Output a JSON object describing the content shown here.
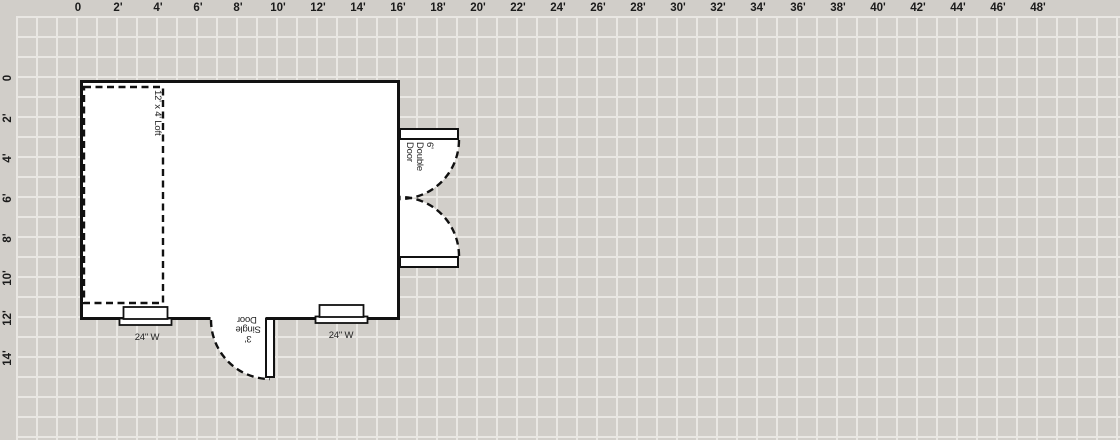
{
  "canvas": {
    "background_color": "#d1cec9",
    "gridline_color": "#e9e7e3",
    "wall_color": "#111111",
    "fill_color": "#ffffff"
  },
  "ruler": {
    "top_labels": [
      "0",
      "2'",
      "4'",
      "6'",
      "8'",
      "10'",
      "12'",
      "14'",
      "16'",
      "18'",
      "20'",
      "22'",
      "24'",
      "26'",
      "28'",
      "30'",
      "32'",
      "34'",
      "36'",
      "38'",
      "40'",
      "42'",
      "44'",
      "46'",
      "48'"
    ],
    "left_labels": [
      "0",
      "2'",
      "4'",
      "6'",
      "8'",
      "10'",
      "12'",
      "14'"
    ]
  },
  "plan": {
    "loft": {
      "label": "12' x 4' Loft"
    },
    "double_door": {
      "lines": [
        "6'",
        "Double",
        "Door"
      ]
    },
    "single_door": {
      "lines": [
        "3'",
        "Single",
        "Door"
      ]
    },
    "windows": [
      {
        "label": "24\" W"
      },
      {
        "label": "24\" W"
      }
    ]
  }
}
